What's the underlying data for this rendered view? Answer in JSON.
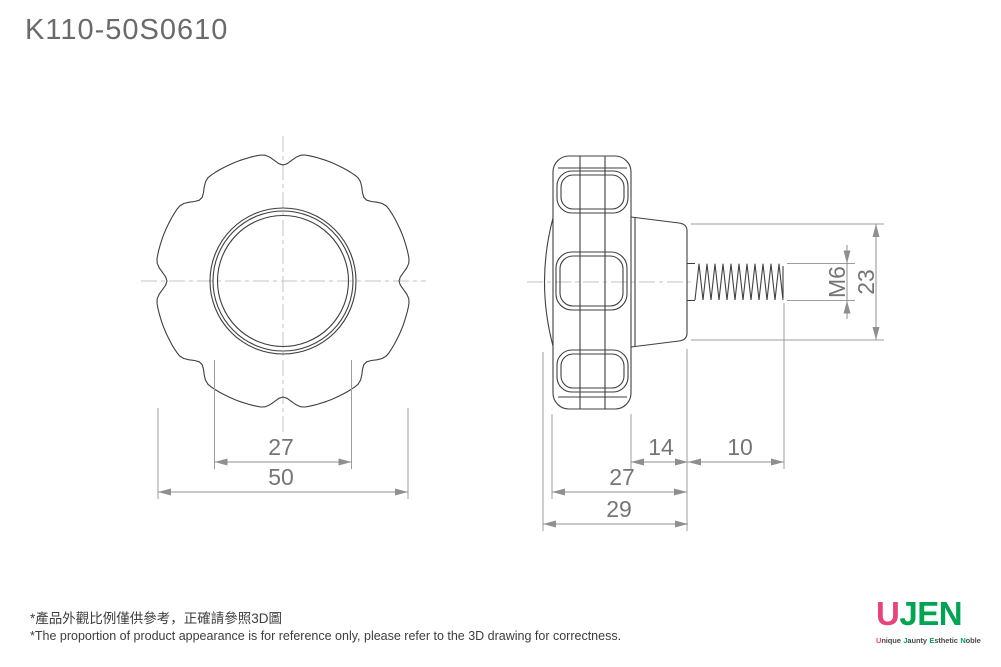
{
  "title": "K110-50S0610",
  "front_view": {
    "dim_boss_diameter": "27",
    "dim_knob_diameter": "50"
  },
  "side_view": {
    "dim_hub_length": "14",
    "dim_thread_exposed": "10",
    "dim_body_depth": "27",
    "dim_total_depth": "29",
    "dim_thread_size": "M6",
    "dim_hub_diameter": "23"
  },
  "footer": {
    "note_zh": "*產品外觀比例僅供參考，正確請參照3D圖",
    "note_en": "*The proportion of product appearance is for reference only, please refer to the 3D drawing for correctness."
  },
  "logo": {
    "brand_u": "U",
    "brand_jen": "JEN",
    "tagline": [
      "Unique",
      "Jaunty",
      "Esthetic",
      "Noble"
    ],
    "color_pink": "#e8437a",
    "color_green": "#00a551"
  }
}
